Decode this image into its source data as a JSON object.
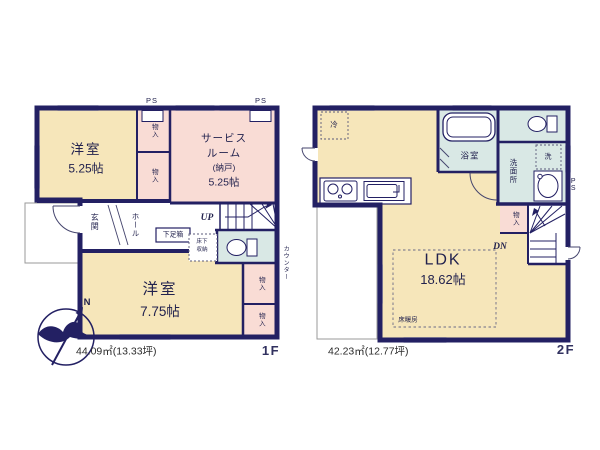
{
  "compass": {
    "north": "N"
  },
  "floor1": {
    "label": "1F",
    "area": "44.09㎡(13.33坪)",
    "bedroom1": {
      "name": "洋室",
      "size": "5.25帖"
    },
    "service_room": {
      "line1": "サービス",
      "line2": "ルーム",
      "line3": "(納戸)",
      "size": "5.25帖"
    },
    "bedroom2": {
      "name": "洋室",
      "size": "7.75帖"
    },
    "entrance": "玄関",
    "hall": "ホール",
    "up": "UP",
    "ps": "PS",
    "shoe_box": "下足箱",
    "underfloor_storage": {
      "line1": "床下",
      "line2": "収納"
    },
    "closet": "物入",
    "counter": "カウンター"
  },
  "floor2": {
    "label": "2F",
    "area": "42.23㎡(12.77坪)",
    "ldk": {
      "name": "LDK",
      "size": "18.62帖"
    },
    "bathroom": "浴室",
    "washroom": "洗面所",
    "laundry": "洗",
    "fridge": "冷",
    "closet": "物入",
    "floor_heating": "床暖房",
    "dn": "DN",
    "ps": "PS"
  },
  "colors": {
    "wall": "#232063",
    "room_cream": "#F6E6BA",
    "room_pink": "#F9DCD5",
    "room_blue": "#D9E8E5"
  }
}
